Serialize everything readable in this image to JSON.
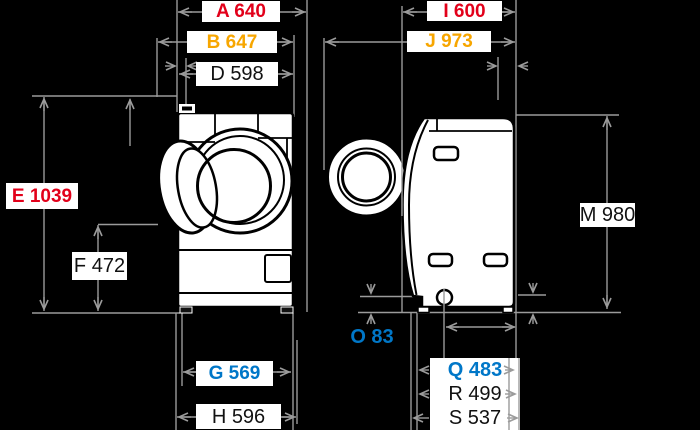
{
  "colors": {
    "background": "#000000",
    "drawing_stroke": "#000000",
    "drawing_fill": "#ffffff",
    "dimension_line": "#9b9b9b",
    "label_background": "#ffffff",
    "red": "#e2001a",
    "orange": "#f7a600",
    "blue": "#0077c8",
    "black_text": "#111111"
  },
  "dims": {
    "A": {
      "text": "A 640",
      "color": "#e2001a"
    },
    "B": {
      "text": "B 647",
      "color": "#f7a600"
    },
    "D": {
      "text": "D 598",
      "color": "#111111"
    },
    "E": {
      "text": "E 1039",
      "color": "#e2001a"
    },
    "F": {
      "text": "F 472",
      "color": "#111111"
    },
    "G": {
      "text": "G 569",
      "color": "#0077c8"
    },
    "H": {
      "text": "H 596",
      "color": "#111111"
    },
    "I": {
      "text": "I 600",
      "color": "#e2001a"
    },
    "J": {
      "text": "J 973",
      "color": "#f7a600"
    },
    "M": {
      "text": "M 980",
      "color": "#111111"
    },
    "O": {
      "text": "O 83",
      "color": "#0077c8"
    },
    "Q": {
      "text": "Q 483",
      "color": "#0077c8"
    },
    "R": {
      "text": "R 499",
      "color": "#111111"
    },
    "S": {
      "text": "S 537",
      "color": "#111111"
    }
  }
}
